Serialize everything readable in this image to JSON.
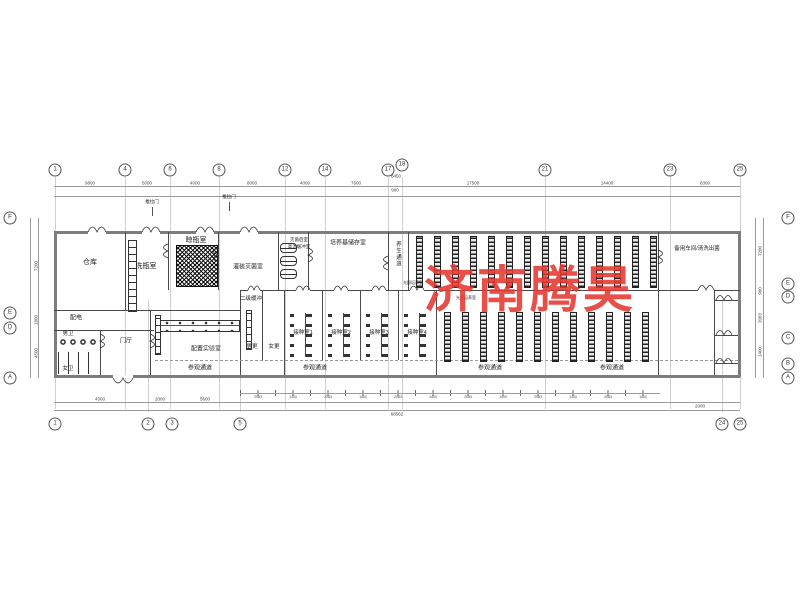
{
  "watermark": {
    "text": "济南腾昊",
    "color": "#e63730"
  },
  "labels": {
    "warehouse": "仓库",
    "bottle_wash": "洗瓶室",
    "bottle_dry": "晾瓶室",
    "filling_sterilize": "灌装灭菌室",
    "post_sterilize": "灭菌后室",
    "hot_buffer": "高温缓冲室",
    "medium_storage": "培养基储存室",
    "curing_corridor": "养生通道",
    "spare_workshop": "备用车间/清洗出菌",
    "power_room": "配电",
    "mens_wc": "男卫",
    "womens_wc": "女卫",
    "foyer": "门厅",
    "prep_lab": "配置实验室",
    "buffer2": "二级缓冲",
    "mens_change": "男更",
    "womens_change": "女更",
    "inoc1": "接种室1",
    "inoc2": "接种室2",
    "inoc3": "接种室3",
    "inoc4": "接种室4",
    "light_room": [
      "光照培养室",
      "光照培养室"
    ],
    "visit_corridor": [
      "参观通道",
      "参观通道",
      "参观通道",
      "参观通道"
    ],
    "sliding_door": [
      "推拉门",
      "推拉门"
    ]
  },
  "grid": {
    "top": [
      "1",
      "4",
      "6",
      "8",
      "12",
      "14",
      "17",
      "18",
      "21",
      "23",
      "25"
    ],
    "bottom": [
      "1",
      "2",
      "3",
      "5",
      "24",
      "25"
    ],
    "left": [
      "F",
      "E",
      "D",
      "A"
    ],
    "right": [
      "F",
      "E",
      "D",
      "C",
      "B",
      "A"
    ]
  },
  "dims": {
    "top": [
      "9800",
      "5000",
      "4000",
      "8000",
      "4000",
      "7600",
      "900",
      "17500",
      "14400",
      "8300"
    ],
    "top_extra": "8450",
    "bottom": [
      "4300",
      "2000",
      "5600"
    ],
    "bottom_right": "2000",
    "series": [
      "2083",
      "1400",
      "2083",
      "1400",
      "2083",
      "1400",
      "2083",
      "1400",
      "2083",
      "1400",
      "2083",
      "1400"
    ],
    "left": [
      "7200",
      "1800",
      "4500"
    ],
    "right": [
      "7200",
      "900",
      "2083",
      "1400"
    ],
    "total": "68562"
  }
}
